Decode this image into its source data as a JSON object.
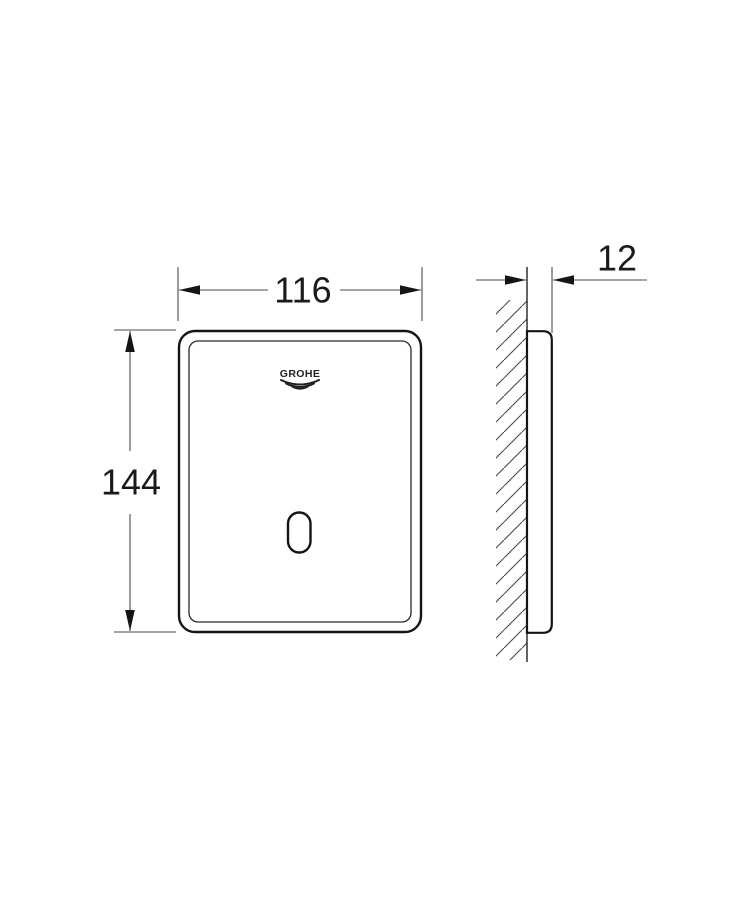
{
  "page": {
    "background": "#ffffff"
  },
  "drawing": {
    "description": "Technical dimension drawing of a wall-mounted flush plate, front view and side profile against hatched wall",
    "logo_text": "GROHE",
    "colors": {
      "outline": "#141414",
      "dimension_lines": "#4a4a4a",
      "text": "#1a1a1a",
      "background": "#ffffff"
    },
    "dimensions": {
      "width": "116",
      "height": "144",
      "depth": "12"
    }
  }
}
